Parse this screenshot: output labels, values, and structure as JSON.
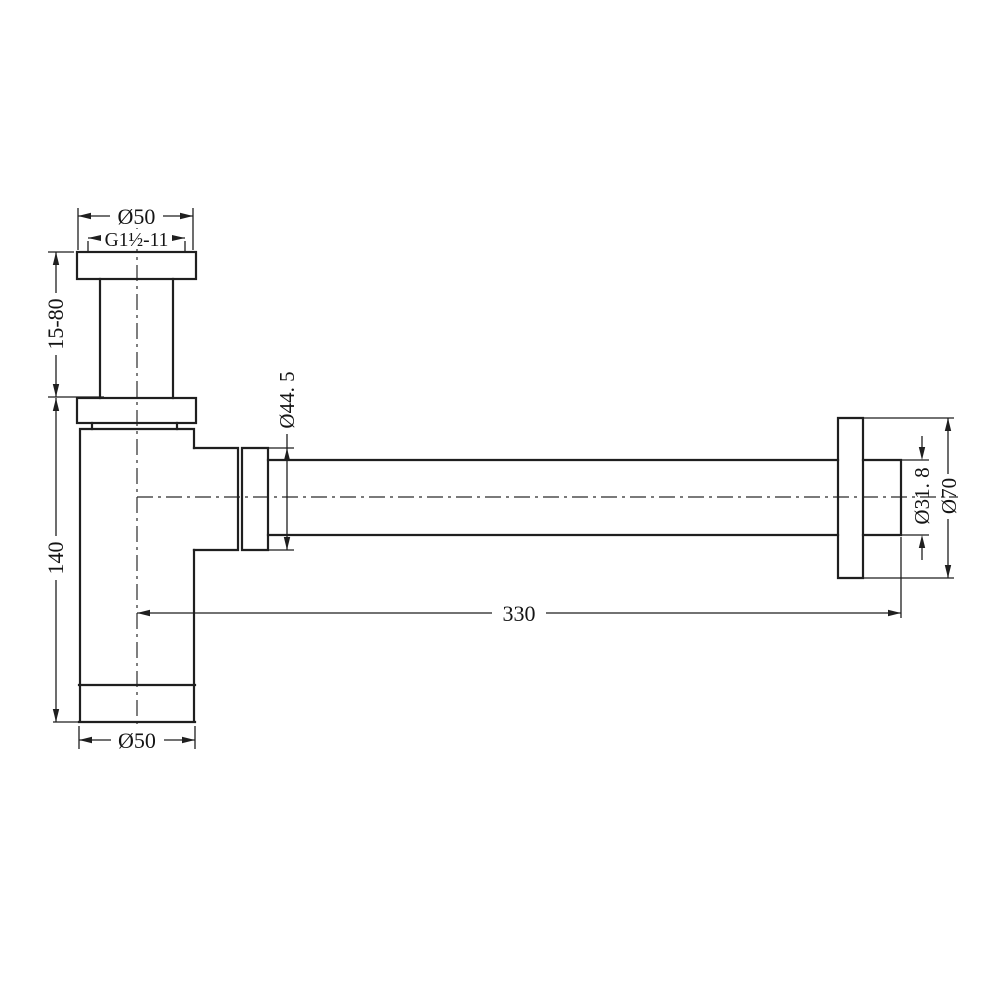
{
  "drawing": {
    "background_color": "#ffffff",
    "line_color": "#1f1f1f",
    "labels": {
      "top_flange_diameter": "Ø50",
      "inlet_thread": "G1½-11",
      "inlet_adjustable_height": "15-80",
      "body_height": "140",
      "outlet_nut_diameter": "Ø44. 5",
      "outlet_projection_length": "330",
      "outlet_pipe_diameter": "Ø31. 8",
      "wall_flange_diameter": "Ø70",
      "body_diameter": "Ø50"
    }
  }
}
